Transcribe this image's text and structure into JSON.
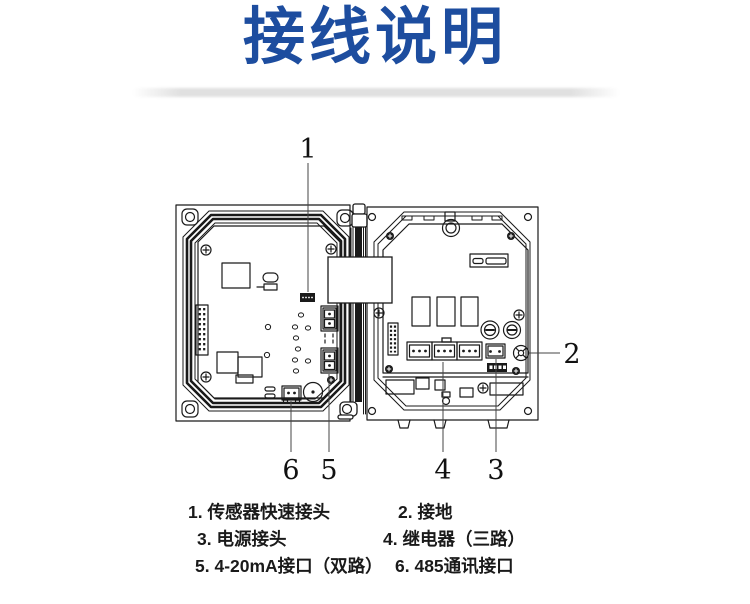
{
  "title": "接线说明",
  "theme": {
    "title_color": "#1d4d9f",
    "line_color": "#1a1a1a"
  },
  "diagram": {
    "callouts": [
      {
        "label": "1"
      },
      {
        "label": "2"
      },
      {
        "label": "3"
      },
      {
        "label": "4"
      },
      {
        "label": "5"
      },
      {
        "label": "6"
      }
    ]
  },
  "legend": {
    "items": [
      {
        "label": "1. 传感器快速接头"
      },
      {
        "label": "2. 接地"
      },
      {
        "label": "3. 电源接头"
      },
      {
        "label": "4. 继电器（三路）"
      },
      {
        "label": "5. 4-20mA接口（双路）"
      },
      {
        "label": "6. 485通讯接口"
      }
    ]
  }
}
